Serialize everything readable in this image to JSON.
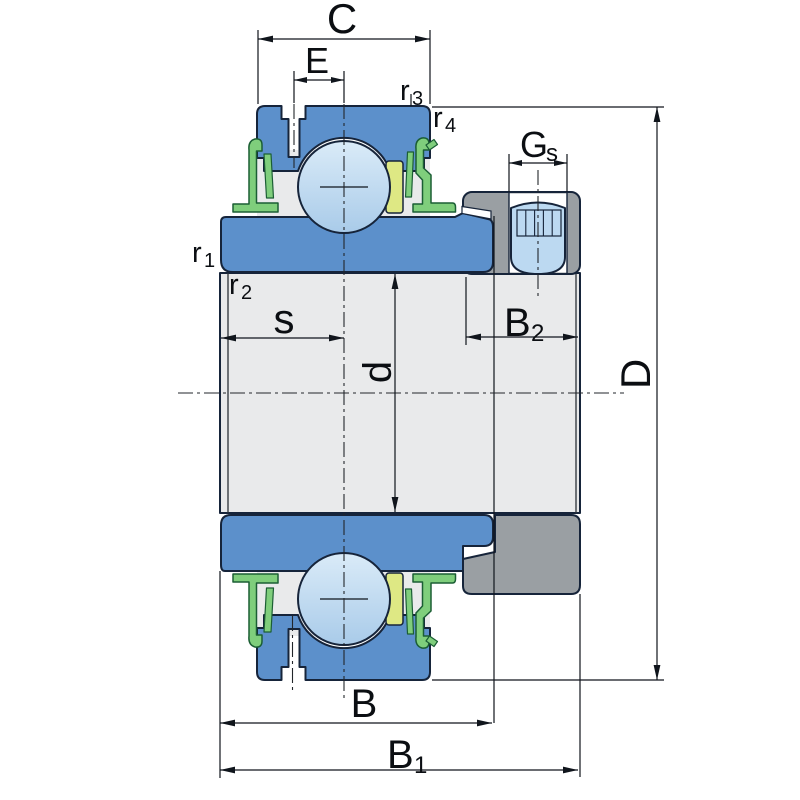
{
  "figure": {
    "type": "bearing-cross-section-drawing",
    "description": "Sectional technical drawing of an insert ball bearing (Y-bearing) with eccentric locking collar, grub screw, flinger seals and dimension designations"
  },
  "labels": {
    "C": {
      "text": "C"
    },
    "E": {
      "text": "E"
    },
    "r3": {
      "base": "r",
      "sub": "3"
    },
    "r4": {
      "base": "r",
      "sub": "4"
    },
    "Gs": {
      "base": "G",
      "sub": "s"
    },
    "r1": {
      "base": "r",
      "sub": "1"
    },
    "r2": {
      "base": "r",
      "sub": "2"
    },
    "s": {
      "text": "s"
    },
    "B2": {
      "base": "B",
      "sub": "2"
    },
    "d": {
      "text": "d"
    },
    "D": {
      "text": "D"
    },
    "B": {
      "text": "B"
    },
    "B1": {
      "base": "B",
      "sub": "1"
    }
  },
  "colors": {
    "ring_blue": "#5C90CB",
    "collar_gray": "#9A9FA3",
    "seal_green": "#7FCE7C",
    "seal_green_dark": "#1B5E34",
    "cage_yellow": "#DEE884",
    "screw_blue": "#BCD9F1",
    "interior_gray": "#E9EAEB",
    "outline": "#16243A",
    "ball_gradient_top": "#DAEBF8",
    "ball_gradient_bottom": "#A9CBE9",
    "dimension_line": "#10151C"
  }
}
